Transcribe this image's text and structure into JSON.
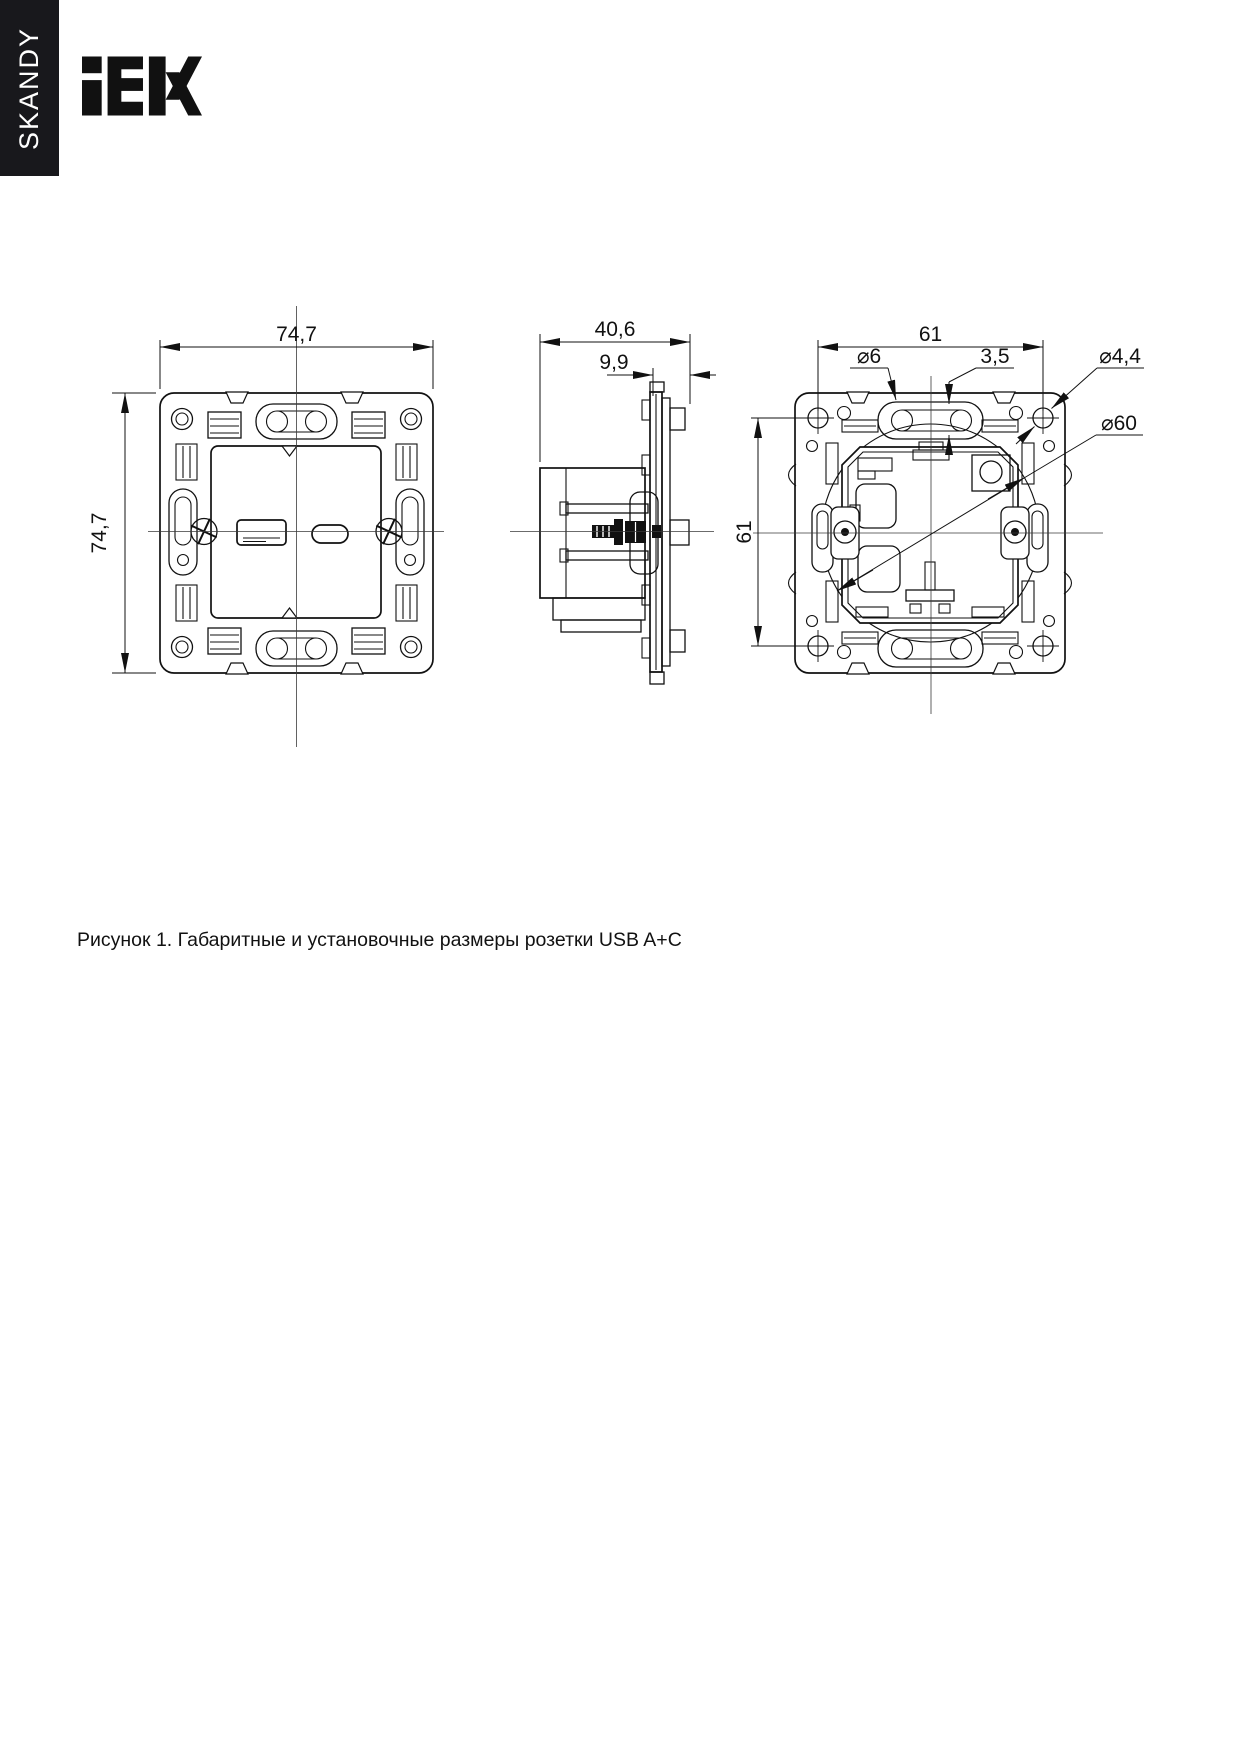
{
  "brand_bar": {
    "series": "SKANDY"
  },
  "logo": {
    "brand": "IEK"
  },
  "figure": {
    "caption": "Рисунок 1. Габаритные и установочные размеры розетки USB A+C",
    "views": {
      "front": {
        "width": "74,7",
        "height": "74,7"
      },
      "side": {
        "overall_depth": "40,6",
        "frame_depth": "9,9"
      },
      "back": {
        "hole_spacing_horizontal": "61",
        "hole_spacing_vertical": "61",
        "slot_diameter": "⌀6",
        "slot_width": "3,5",
        "hole_diameter": "⌀4,4",
        "installation_diameter": "⌀60"
      }
    }
  }
}
